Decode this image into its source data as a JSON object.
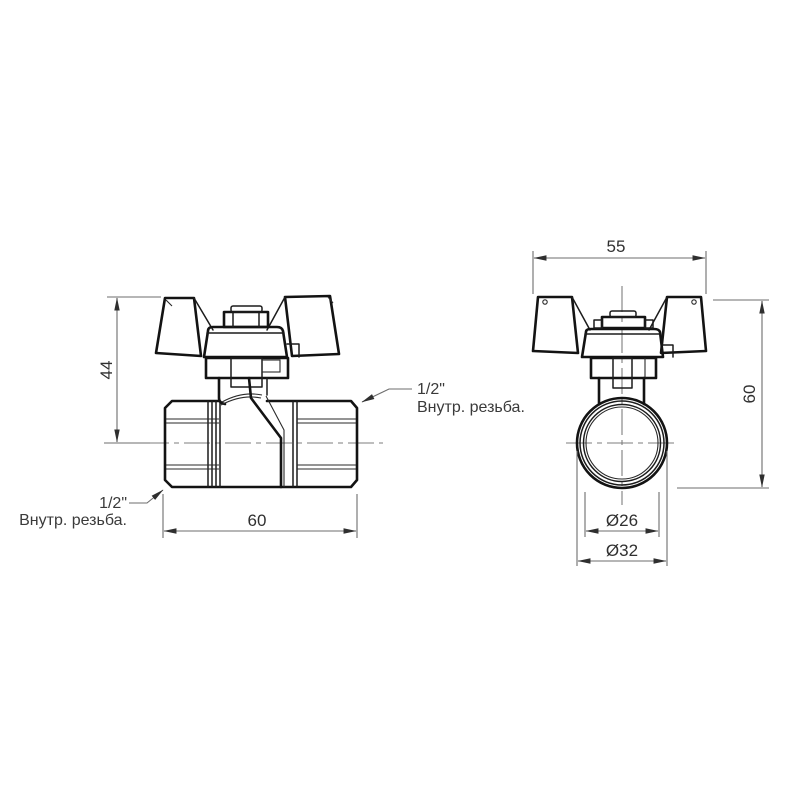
{
  "drawing": {
    "kind": "technical-drawing",
    "subject": "ball valve with butterfly T-handle, female/female, two orthographic views",
    "colors": {
      "background": "#ffffff",
      "object_lines": "#131313",
      "dimension_lines": "#6d6d6d",
      "text": "#303030"
    },
    "side_view": {
      "height_dim": "44",
      "width_dim": "60",
      "thread_label_top": {
        "line1": "1/2\"",
        "line2": "Внутр. резьба."
      },
      "thread_label_bottom": {
        "line1": "1/2\"",
        "line2": "Внутр. резьба."
      }
    },
    "front_view": {
      "width_dim": "55",
      "height_dim": "60",
      "bore_dim": "Ø26",
      "outer_dim": "Ø32"
    }
  }
}
